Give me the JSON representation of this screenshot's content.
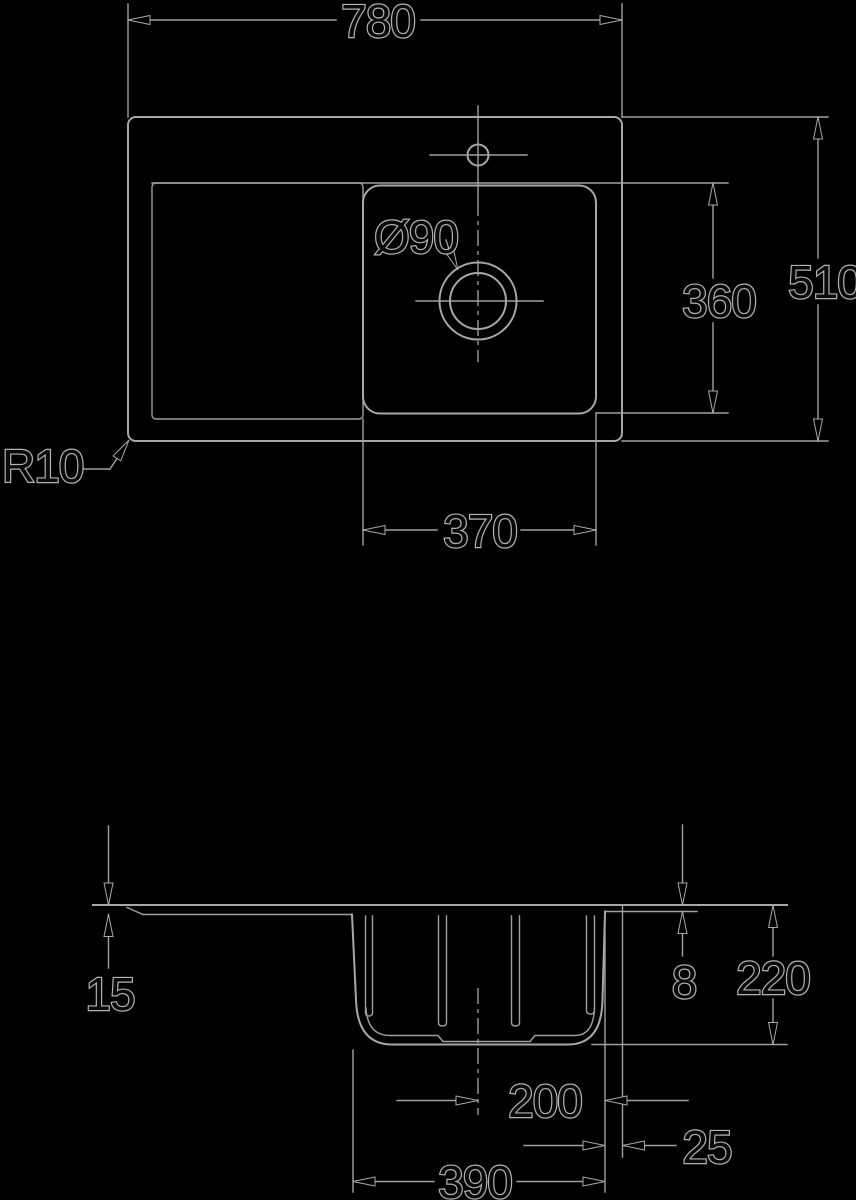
{
  "title": "Sink technical drawing with dimensions",
  "colors": {
    "background": "#000000",
    "line": "#a0a0a0",
    "text_fill": "#0a0a0a",
    "text_halo": "#b2b2b2"
  },
  "plan_view": {
    "dimensions": {
      "overall_width": "780",
      "overall_depth": "510",
      "bowl_front_back": "360",
      "bowl_width_inner": "370",
      "drain_diameter": "Ø90",
      "corner_radius": "R10"
    }
  },
  "section_view": {
    "dimensions": {
      "rim_height_left": "15",
      "rim_height_right": "8",
      "bowl_depth": "220",
      "center_to_bowl_edge": "200",
      "bowl_edge_to_outer_edge": "25",
      "bowl_outer_width": "390"
    }
  }
}
